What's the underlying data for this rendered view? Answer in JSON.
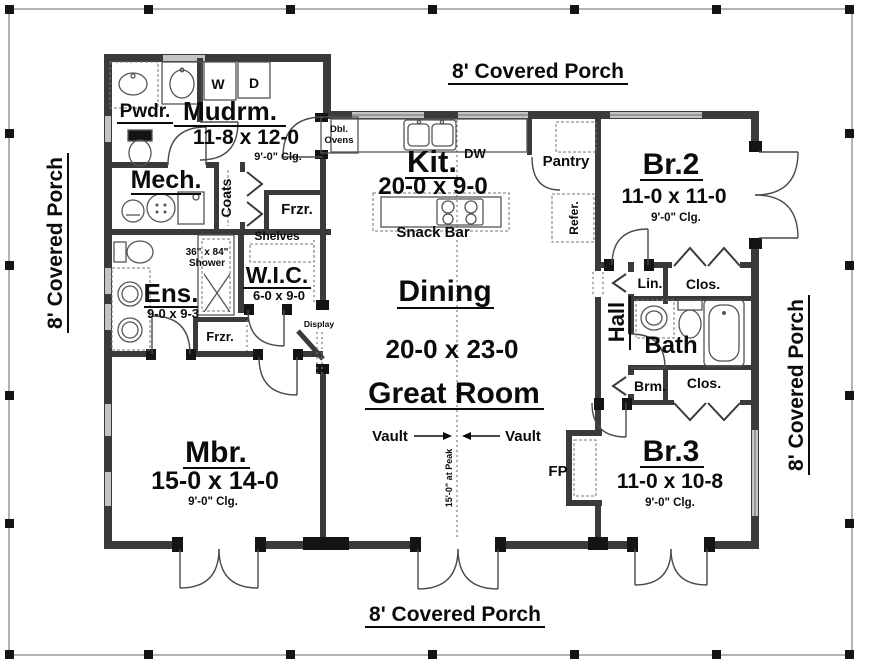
{
  "plan": {
    "porch": {
      "top": "8' Covered Porch",
      "bottom": "8' Covered Porch",
      "left": "8' Covered Porch",
      "right": "8' Covered Porch"
    },
    "rooms": {
      "mudrm": {
        "name": "Mudrm.",
        "dims": "11-8 x 12-0",
        "clg": "9'-0\" Clg."
      },
      "pwdr": {
        "name": "Pwdr."
      },
      "mech": {
        "name": "Mech."
      },
      "coats": {
        "name": "Coats"
      },
      "frzr_upper": {
        "name": "Frzr."
      },
      "frzr_lower": {
        "name": "Frzr."
      },
      "shelves": {
        "name": "Shelves"
      },
      "shower": {
        "line1": "36\" x 84\"",
        "line2": "Shower"
      },
      "wic": {
        "name": "W.I.C.",
        "dims": "6-0 x 9-0"
      },
      "ens": {
        "name": "Ens.",
        "dims": "9-0 x 9-3"
      },
      "display": {
        "name": "Display"
      },
      "kit": {
        "name": "Kit.",
        "dims": "20-0 x 9-0",
        "dw": "DW",
        "snack_bar": "Snack Bar"
      },
      "dbl_ovens": {
        "line1": "Dbl.",
        "line2": "Ovens"
      },
      "washer": "W",
      "dryer": "D",
      "pantry": {
        "name": "Pantry"
      },
      "refer": {
        "name": "Refer."
      },
      "dining": {
        "name": "Dining"
      },
      "great_room": {
        "name": "Great Room",
        "dims": "20-0 x 23-0",
        "vault_left": "Vault",
        "vault_right": "Vault",
        "peak": "15'-0\" at Peak"
      },
      "mbr": {
        "name": "Mbr.",
        "dims": "15-0 x 14-0",
        "clg": "9'-0\" Clg."
      },
      "br2": {
        "name": "Br.2",
        "dims": "11-0 x 11-0",
        "clg": "9'-0\" Clg."
      },
      "br3": {
        "name": "Br.3",
        "dims": "11-0 x 10-8",
        "clg": "9'-0\" Clg."
      },
      "hall": {
        "name": "Hall"
      },
      "bath": {
        "name": "Bath"
      },
      "lin": {
        "name": "Lin."
      },
      "clos_top": {
        "name": "Clos."
      },
      "clos_bottom": {
        "name": "Clos."
      },
      "brm": {
        "name": "Brm."
      },
      "fp": {
        "name": "FP"
      }
    }
  }
}
